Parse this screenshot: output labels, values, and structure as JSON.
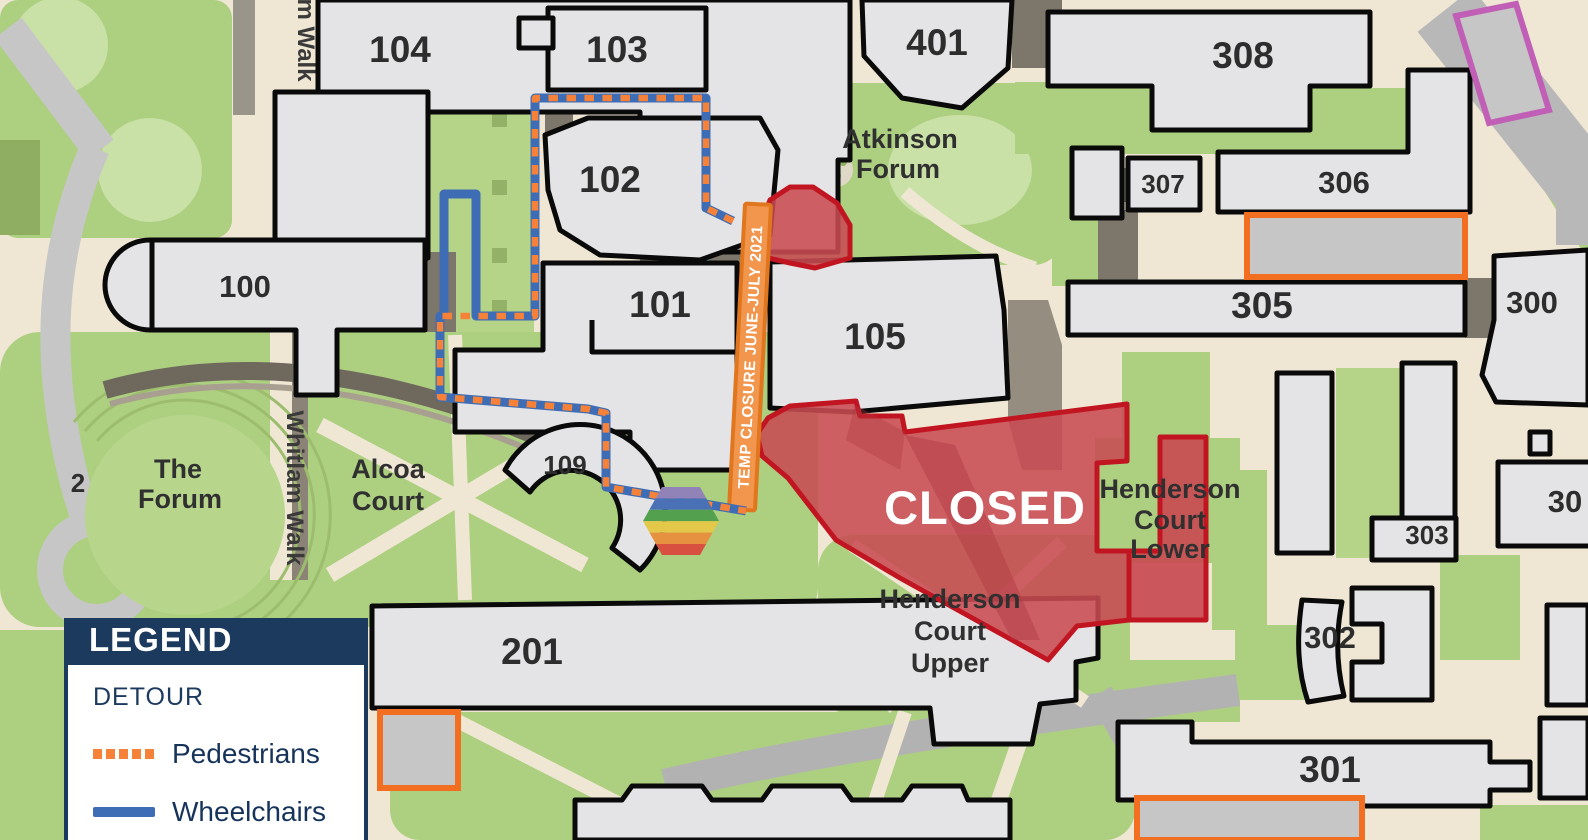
{
  "map": {
    "buildings": {
      "b100": "100",
      "b101": "101",
      "b102": "102",
      "b103": "103",
      "b104": "104",
      "b105": "105",
      "b109": "109",
      "b201": "201",
      "b300": "300",
      "b301": "301",
      "b302": "302",
      "b303": "303",
      "b304_partial": "30",
      "b305": "305",
      "b306": "306",
      "b307": "307",
      "b308": "308",
      "b401": "401"
    },
    "places": {
      "atkinson_forum": [
        "Atkinson",
        "Forum"
      ],
      "the_forum": [
        "The",
        "Forum"
      ],
      "alcoa_court": [
        "Alcoa",
        "Court"
      ],
      "henderson_upper": [
        "Henderson",
        "Court",
        "Upper"
      ],
      "henderson_lower": [
        "Henderson",
        "Court",
        "Lower"
      ],
      "whitlam_walk": "Whitlam Walk",
      "whitlam_walk_partial": "m Walk",
      "road_number": "2"
    },
    "closure": {
      "banner": "TEMP CLOSURE JUNE-JULY 2021",
      "closed": "CLOSED"
    }
  },
  "legend": {
    "title": "LEGEND",
    "section": "DETOUR",
    "items": [
      {
        "label": "Pedestrians",
        "line_style": "dotted",
        "color": "#f58238"
      },
      {
        "label": "Wheelchairs",
        "line_style": "solid",
        "color": "#3e6db5"
      }
    ]
  },
  "colors": {
    "pedestrian_detour": "#f58238",
    "wheelchair_detour": "#3e6db5",
    "closed_fill": "#c84b52",
    "closed_border": "#c11622",
    "banner_fill": "#f2954d",
    "banner_border": "#e0761d",
    "legend_navy": "#1b3a5e",
    "water": "#3fc3d4",
    "parking_orange": "#f26f21",
    "parking_magenta": "#c05fb5"
  }
}
